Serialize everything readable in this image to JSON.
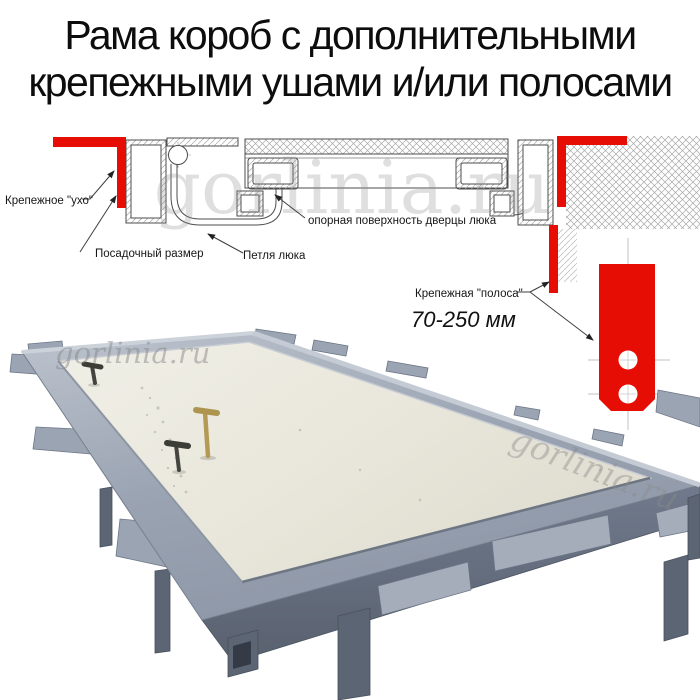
{
  "title": {
    "line1": "Рама короб с дополнительными",
    "line2": "крепежными ушами и/или полосами"
  },
  "diagram": {
    "labels": {
      "ear": "Крепежное \"ухо\"",
      "seat": "Посадочный размер",
      "hinge": "Петля люка",
      "support": "опорная поверхность дверцы люка",
      "strip": "Крепежная \"полоса\"",
      "strip_size": "70-250 мм"
    },
    "colors": {
      "accent_red": "#e60d05",
      "line": "#4d4d4d",
      "hatch": "#a8a8a8"
    }
  },
  "photo": {
    "colors": {
      "frame_gray": "#a3abba",
      "panel_cream": "#e9e7db",
      "leg_dark": "#5c6574",
      "key_brass": "#ad9550",
      "key_dark": "#3d3d37"
    }
  },
  "watermark": {
    "text": "gorlinia.ru"
  }
}
